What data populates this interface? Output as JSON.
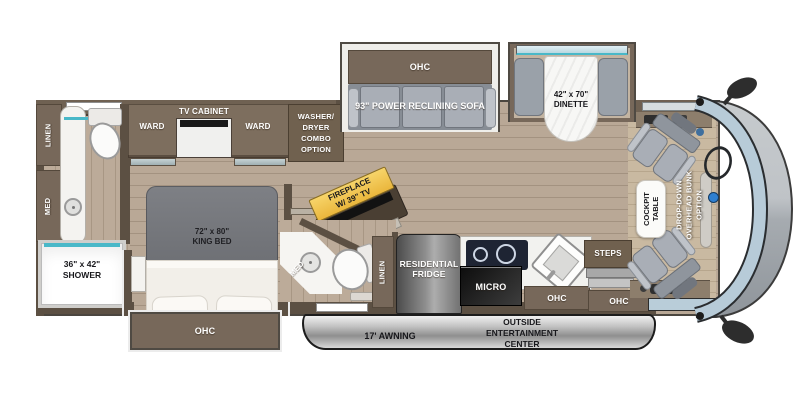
{
  "title": "Class A Motorhome Floor Plan",
  "colors": {
    "cabinet_brown": "#77685A",
    "wall_brown": "#5C5043",
    "floor_wood": "#B6A593",
    "accent_teal": "#49B8C8",
    "fireplace_gold": "#F2C64D",
    "upholstery_gray": "#AEB3BA",
    "awning_silver": "#C9C9C9",
    "windshield_blue": "#B7CBD8"
  },
  "rear_bath": {
    "linen": "LINEN",
    "med": "MED",
    "shower_size": "36\" x 42\"",
    "shower": "SHOWER"
  },
  "bedroom": {
    "ward_left": "WARD",
    "tv_cabinet": "TV CABINET",
    "ward_right": "WARD",
    "washer_dryer": [
      "WASHER/",
      "DRYER",
      "COMBO",
      "OPTION"
    ],
    "bed_size": "72\" x 80\"",
    "bed": "KING BED",
    "ohc": "OHC"
  },
  "living": {
    "sofa_ohc": "OHC",
    "sofa": "93\" POWER RECLINING SOFA",
    "dinette_size": "42\" x 70\"",
    "dinette": "DINETTE",
    "fireplace_line1": "FIREPLACE",
    "fireplace_line2": "W/ 39\" TV"
  },
  "mid_bath": {
    "med": "MED",
    "linen": "LINEN"
  },
  "kitchen": {
    "fridge_line1": "RESIDENTIAL",
    "fridge_line2": "FRIDGE",
    "micro": "MICRO",
    "ohc": "OHC",
    "steps": "STEPS",
    "ohc_entry": "OHC"
  },
  "cockpit": {
    "table_line1": "COCKPIT",
    "table_line2": "TABLE",
    "bunk_line1": "DROP-DOWN",
    "bunk_line2": "OVERHEAD BUNK",
    "bunk_line3": "OPTION"
  },
  "exterior": {
    "awning": "17' AWNING",
    "entertainment": [
      "OUTSIDE",
      "ENTERTAINMENT",
      "CENTER"
    ]
  }
}
